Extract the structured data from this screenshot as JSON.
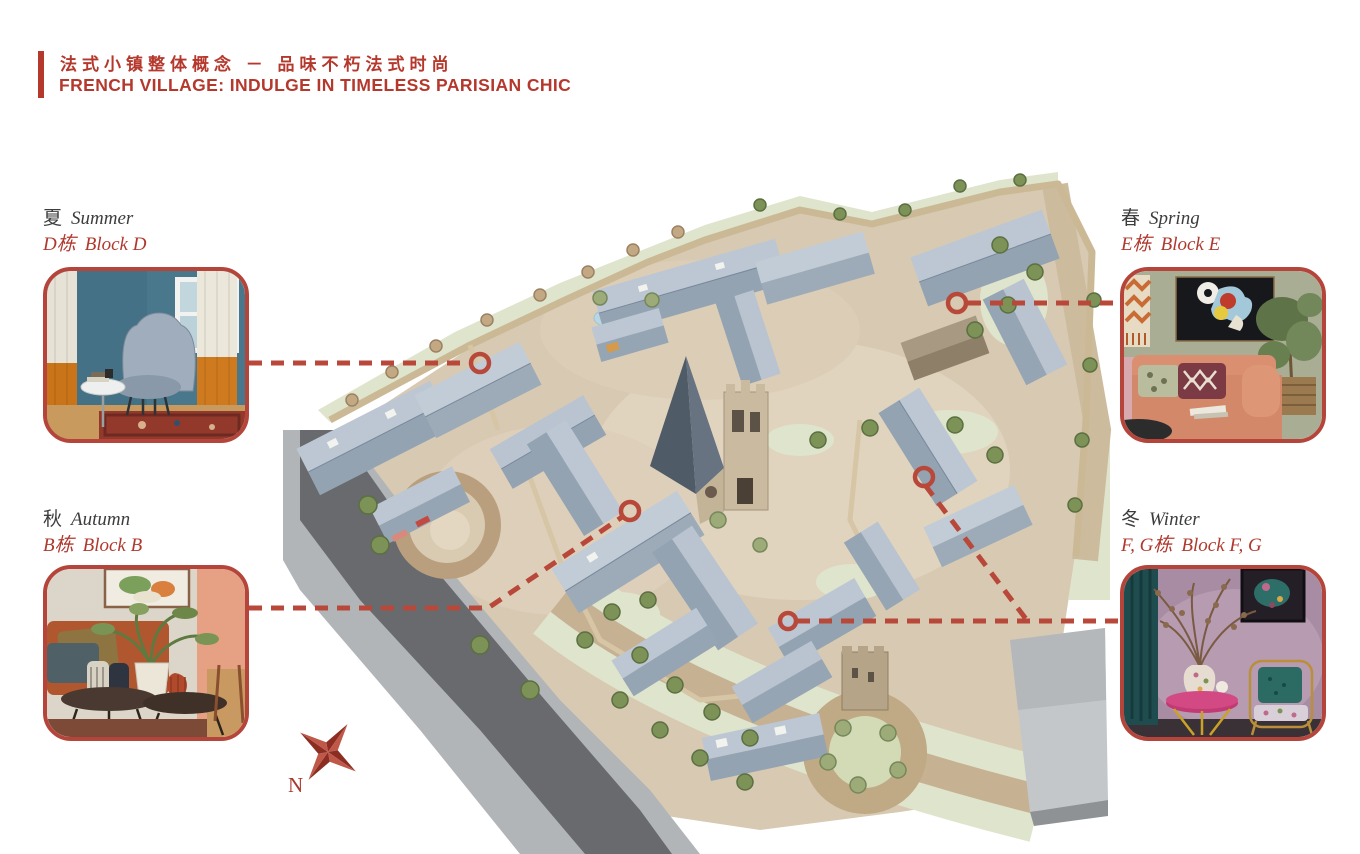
{
  "header": {
    "title_zh": "法式小镇整体概念 － 品味不朽法式时尚",
    "title_en": "FRENCH VILLAGE: INDULGE IN TIMELESS PARISIAN CHIC"
  },
  "callouts": {
    "summer": {
      "season_zh": "夏",
      "season_en": "Summer",
      "block_zh": "D栋",
      "block_en": "Block D"
    },
    "spring": {
      "season_zh": "春",
      "season_en": "Spring",
      "block_zh": "E栋",
      "block_en": "Block E"
    },
    "autumn": {
      "season_zh": "秋",
      "season_en": "Autumn",
      "block_zh": "B栋",
      "block_en": "Block B"
    },
    "winter": {
      "season_zh": "冬",
      "season_en": "Winter",
      "block_zh": "F, G栋",
      "block_en": "Block F, G"
    }
  },
  "map": {
    "compass_label": "N"
  },
  "colors": {
    "accent": "#b5382d",
    "connector": "#b8483a",
    "card_border": "#b5453a",
    "roof_light": "#b9c4d0",
    "roof_dark": "#93a3b2",
    "cobble": "#d8c9b2",
    "road": "#686a6d",
    "green": "#dfe4cc"
  }
}
